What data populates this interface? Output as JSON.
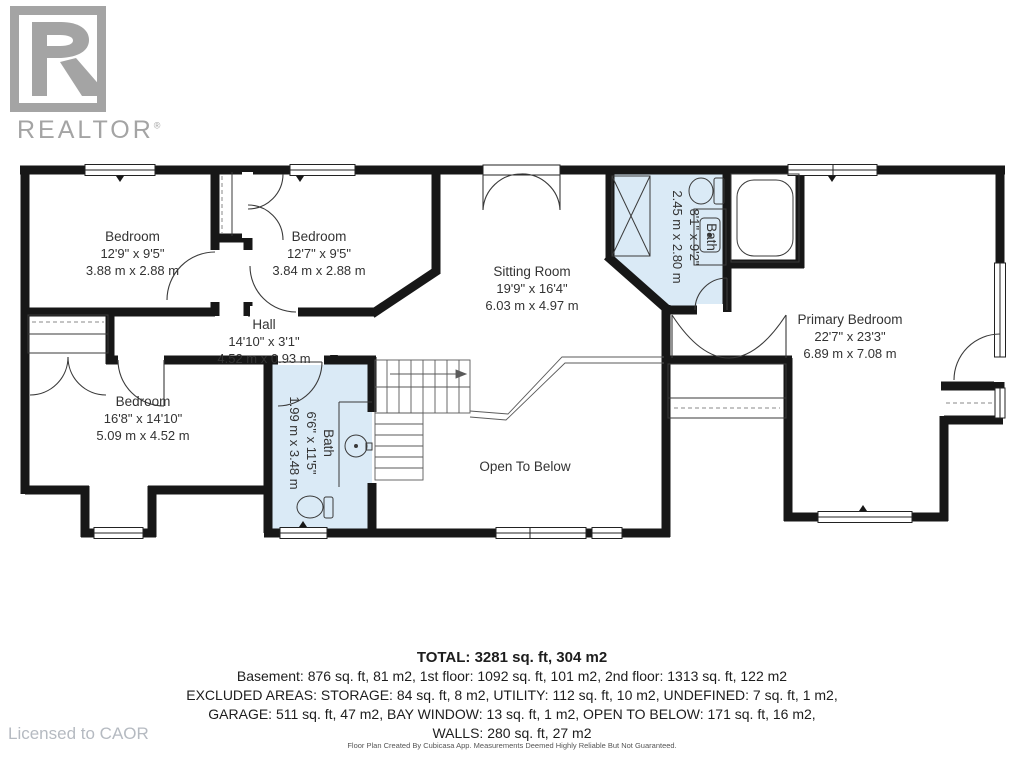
{
  "branding": {
    "logo_text": "REALTOR",
    "registered_mark": "®",
    "licensed_to": "Licensed to CAOR"
  },
  "rooms": [
    {
      "id": "bedroom-top-left",
      "name": "Bedroom",
      "imperial": "12'9\" x 9'5\"",
      "metric": "3.88 m x 2.88 m"
    },
    {
      "id": "bedroom-top-center",
      "name": "Bedroom",
      "imperial": "12'7\" x 9'5\"",
      "metric": "3.84 m x 2.88 m"
    },
    {
      "id": "sitting-room",
      "name": "Sitting Room",
      "imperial": "19'9\" x 16'4\"",
      "metric": "6.03 m x 4.97 m"
    },
    {
      "id": "bath-upper",
      "name": "Bath",
      "imperial": "8'1\" x 9'2\"",
      "metric": "2.45 m x 2.80 m"
    },
    {
      "id": "primary-bedroom",
      "name": "Primary Bedroom",
      "imperial": "22'7\" x 23'3\"",
      "metric": "6.89 m x 7.08 m"
    },
    {
      "id": "hall",
      "name": "Hall",
      "imperial": "14'10\" x 3'1\"",
      "metric": "4.52 m x 0.93 m"
    },
    {
      "id": "bedroom-lower-left",
      "name": "Bedroom",
      "imperial": "16'8\" x 14'10\"",
      "metric": "5.09 m x 4.52 m"
    },
    {
      "id": "bath-lower",
      "name": "Bath",
      "imperial": "6'6\" x 11'5\"",
      "metric": "1.99 m x 3.48 m"
    },
    {
      "id": "open-to-below",
      "name": "Open To Below"
    }
  ],
  "summary": {
    "total": "TOTAL: 3281 sq. ft, 304 m2",
    "floors": "Basement: 876 sq. ft, 81 m2, 1st floor: 1092 sq. ft, 101 m2, 2nd floor: 1313 sq. ft, 122 m2",
    "excluded1": "EXCLUDED AREAS: STORAGE: 84 sq. ft, 8 m2, UTILITY: 112 sq. ft, 10 m2, UNDEFINED: 7 sq. ft, 1 m2,",
    "excluded2": "GARAGE: 511 sq. ft, 47 m2, BAY WINDOW: 13 sq. ft, 1 m2, OPEN TO BELOW: 171 sq. ft, 16 m2,",
    "walls": "WALLS: 280 sq. ft, 27 m2"
  },
  "footnote": "Floor Plan Created By Cubicasa App. Measurements Deemed Highly Reliable But Not Guaranteed.",
  "colors": {
    "wall": "#171717",
    "bath_fill": "#daeaf6",
    "label_text": "#333333",
    "logo_gray": "#a4a4a4",
    "licensed_gray": "#b5bac1"
  }
}
